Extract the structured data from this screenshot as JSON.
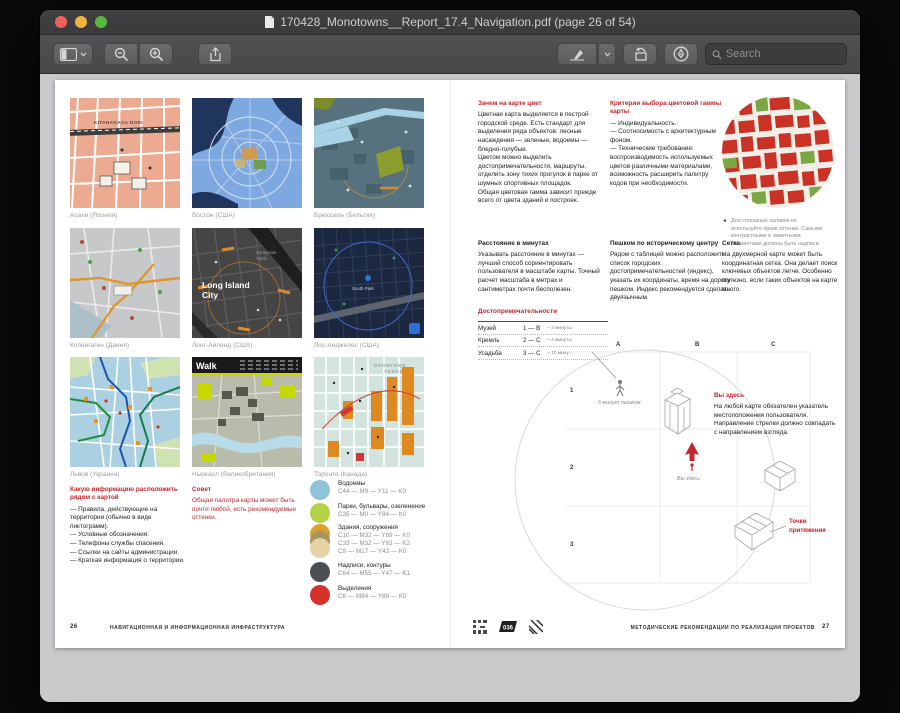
{
  "window": {
    "title": "170428_Monotowns__Report_17.4_Navigation.pdf (page 26 of 54)",
    "toolbar": {
      "search_placeholder": "Search"
    }
  },
  "colors": {
    "accent_red": "#c5262b",
    "water": "#8fc3da",
    "park": "#b5d145",
    "building1": "#d7a233",
    "building2": "#a59360",
    "building3": "#e6d3a3",
    "labels": "#4c4f52",
    "highlight": "#d4322b"
  },
  "doc": {
    "left": {
      "maps": [
        {
          "caption": "Асахи (Япония)",
          "label": "KITANAGASA DORI"
        },
        {
          "caption": "Бостон (США)"
        },
        {
          "caption": "Брюссель (Бельгия)"
        },
        {
          "caption": "Копенгаген (Дания)"
        },
        {
          "caption": "Лонг-Айленд (США)",
          "label": "Long Island",
          "label2": "City",
          "label3": "Sunnyside",
          "label4": "Yards"
        },
        {
          "caption": "Лос-Анджелес (США)",
          "label": "South Park"
        },
        {
          "caption": "Львов (Украина)"
        },
        {
          "caption": "Ньюкасл (Великобритания)",
          "label": "Walk"
        },
        {
          "caption": "Торонто (Канада)",
          "label": "DOWNTOWN",
          "label2": "YONGE"
        }
      ],
      "info": {
        "heading": "Какую информацию расположить рядом с картой",
        "items": [
          "— Правила, действующие на территории (обычно в виде пиктограмм).",
          "— Условные обозначения.",
          "— Телефоны службы спасения.",
          "— Ссылки на сайты администрации.",
          "— Краткая информация о территории."
        ]
      },
      "tip": {
        "heading": "Совет",
        "text": "Общая палитра карты может быть почти любой, есть рекомендуемые оттенки."
      },
      "palette": [
        {
          "name": "Водоемы",
          "code1": "C44 — M9 — Y11 — K0"
        },
        {
          "name": "Парки, бульвары, озеленение",
          "code1": "C35 — M0 — Y84 — K0"
        },
        {
          "name": "Здания, сооружения",
          "code1": "C10 — M32 — Y89 — K0",
          "code2": "C33 — M32 — Y63 — K2",
          "code3": "C9 — M17 — Y43 — K0"
        },
        {
          "name": "Надписи, контуры",
          "code1": "C64 — M55 — Y47 — K1"
        },
        {
          "name": "Выделения",
          "code1": "C6 — M94 — Y89 — K0"
        }
      ]
    },
    "right": {
      "why_color": {
        "heading": "Зачем на карте цвет",
        "p1": "Цветная карта выделяется в пестрой городской среде. Есть стандарт для выделения ряда объектов: лесные насаждения — зеленые, водоемы — бледно-голубые.",
        "p2": "Цветом можно выделить достопримечательности, маршруты, отделить зону тихих прогулок в парке от шумных спортивных площадок.",
        "p3": "Общая цветовая гамма зависит прежде всего от цвета зданий и построек."
      },
      "criteria": {
        "heading": "Критерии выбора цветовой гаммы карты",
        "items": [
          "— Индивидуальность.",
          "— Соотносимость с архитектурным фоном.",
          "— Технические требования: воспроизводимость используемых цветов различными материалами, возможность расширить палитру кодов при необходимости."
        ]
      },
      "circle_note": {
        "arrow": "◄",
        "text": "Для сплошных заливок не используйте яркие оттенки. Самыми контрастными и заметными элементами должны быть надписи"
      },
      "minutes": {
        "heading": "Расстояние в минутах",
        "text": "Указывать расстояние в минутах — лучший способ сориентировать пользователя в масштабе карты. Точный расчет масштаба в метрах и сантиметрах почти бесполезен."
      },
      "walking": {
        "heading": "Пешком по историческому центру",
        "text": "Рядом с таблицей можно расположить список городских достопримечательностей (индекс), указать их координаты, время на дорогу пешком. Индекс рекомендуется сделать двуязычным."
      },
      "grid": {
        "heading": "Сетка",
        "text": "На двухмерной карте может быть координатная сетка. Она делает поиск ключевых объектов легче. Особенно полезно, если таких объектов на карте много."
      },
      "landmarks": {
        "heading": "Достопримечательности",
        "rows": [
          {
            "name": "Музей",
            "code": "1 — B",
            "time": "~ 3 минуты"
          },
          {
            "name": "Кремль",
            "code": "2 — C",
            "time": "~ 4 минуты"
          },
          {
            "name": "Усадьба",
            "code": "3 — C",
            "time": "~ 10 минут"
          }
        ]
      },
      "you_are_here": {
        "heading": "Вы здесь",
        "text": "На любой карте обязателен указатель местоположения пользователя. Направление стрелки должно совпадать с направлением взгляда."
      },
      "diagram": {
        "cols": [
          "A",
          "B",
          "C"
        ],
        "rows": [
          "1",
          "2",
          "3"
        ],
        "walk": "5 минут пешком",
        "here": "Вы здесь",
        "attract1": "Точки",
        "attract2": "притяжения"
      }
    },
    "footer": {
      "left_num": "26",
      "left_title": "НАВИГАЦИОННАЯ И ИНФОРМАЦИОННАЯ ИНФРАСТРУКТУРА",
      "badge": "036",
      "right_title": "МЕТОДИЧЕСКИЕ РЕКОМЕНДАЦИИ ПО РЕАЛИЗАЦИИ ПРОЕКТОВ",
      "right_num": "27"
    }
  }
}
